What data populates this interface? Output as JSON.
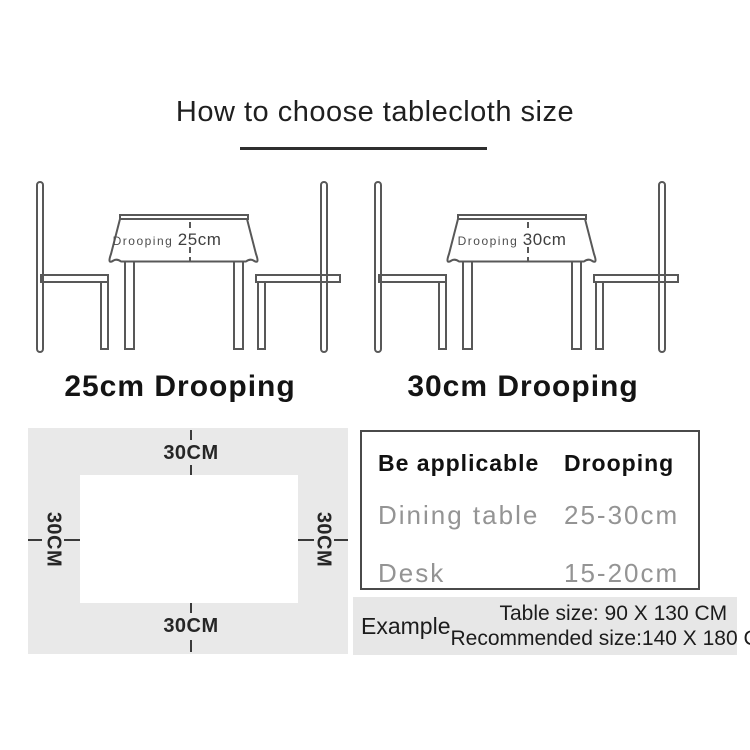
{
  "title": "How to choose tablecloth size",
  "diagrams": [
    {
      "annotation_label": "Drooping",
      "annotation_value": "25cm",
      "caption": "25cm Drooping"
    },
    {
      "annotation_label": "Drooping",
      "annotation_value": "30cm",
      "caption": "30cm Drooping"
    }
  ],
  "dimension_diagram": {
    "top": "30CM",
    "bottom": "30CM",
    "left": "30CM",
    "right": "30CM"
  },
  "spec_table": {
    "headers": [
      "Be applicable",
      "Drooping"
    ],
    "rows": [
      [
        "Dining table",
        "25-30cm"
      ],
      [
        "Desk",
        "15-20cm"
      ]
    ]
  },
  "example": {
    "label": "Example",
    "line1": "Table size:  90 X 130 CM",
    "line2": "Recommended size:140 X 180 CM"
  },
  "colors": {
    "background": "#ffffff",
    "panel_grey": "#e9e9e9",
    "example_grey": "#e7e7e7",
    "line_art": "#585858",
    "text_dark": "#1c1c1c",
    "row_text_grey": "#949494",
    "table_border": "#4a4a4a"
  }
}
